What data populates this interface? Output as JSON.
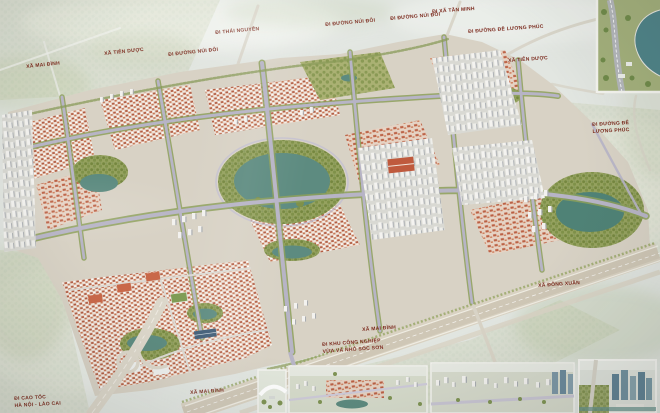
{
  "map": {
    "labels": [
      {
        "id": "xa-mai-dinh-nw",
        "text": "XÃ MAI ĐÌNH"
      },
      {
        "id": "xa-tien-duoc-w",
        "text": "XÃ TIÊN DƯỢC"
      },
      {
        "id": "di-duong-nui-doi-1",
        "text": "ĐI ĐƯỜNG NÚI ĐÔI"
      },
      {
        "id": "di-thai-nguyen",
        "text": "ĐI THÁI NGUYÊN"
      },
      {
        "id": "di-duong-nui-doi-2",
        "text": "ĐI ĐƯỜNG NÚI ĐÔI"
      },
      {
        "id": "di-duong-nui-doi-3",
        "text": "ĐI ĐƯỜNG NÚI ĐÔI"
      },
      {
        "id": "di-xa-tan-minh",
        "text": "ĐI XÃ TÂN MINH"
      },
      {
        "id": "di-duong-de-luong-phuc-1",
        "text": "ĐI ĐƯỜNG ĐÊ LƯƠNG PHÚC"
      },
      {
        "id": "xa-tien-duoc-e",
        "text": "XÃ TIÊN DƯỢC"
      },
      {
        "id": "di-duong-de-luong-phuc-2",
        "text": "ĐI ĐƯỜNG ĐÊ\nLƯƠNG PHÚC"
      },
      {
        "id": "xa-dong-xuan",
        "text": "XÃ ĐÔNG XUÂN"
      },
      {
        "id": "xa-mai-dinh-s",
        "text": "XÃ MAI ĐÌNH"
      },
      {
        "id": "di-khu-cong-nghiep",
        "text": "ĐI KHU CÔNG NGHIỆP\nVỪA VÀ NHỎ SÓC SƠN"
      },
      {
        "id": "xa-mai-dinh-sw",
        "text": "XÃ MAI ĐÌNH"
      },
      {
        "id": "di-cao-toc",
        "text": "ĐI CAO TỐC\nHÀ NỘI - LÀO CAI"
      }
    ]
  },
  "colors": {
    "paper": "#e2e6e1",
    "land-base": "#d8d2c5",
    "lake-teal": "#5d8b80",
    "park-olive": "#95a25e",
    "roof-red": "#bb5f43",
    "road-lavender": "#b7b4c6",
    "highway-beige": "#d9d2c2",
    "tower-white": "#f3f2ef",
    "label-maroon": "#7b2a1d"
  }
}
